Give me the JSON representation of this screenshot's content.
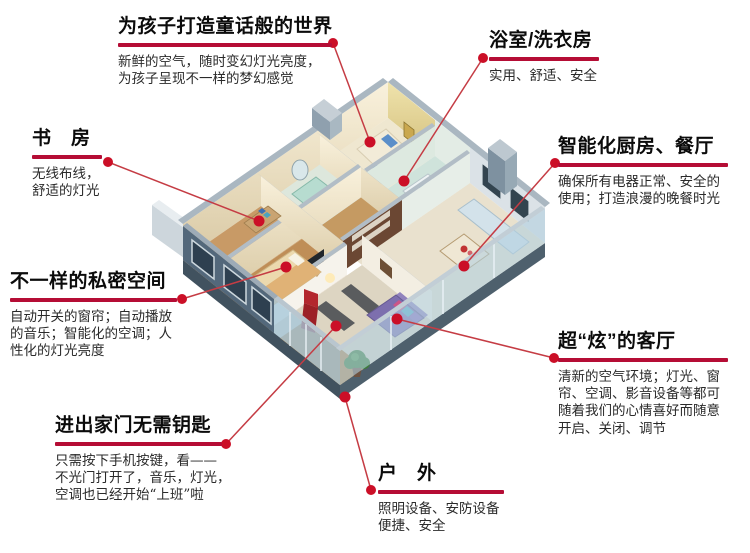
{
  "colors": {
    "accent_red": "#b50d35",
    "connector_red": "#c53c44",
    "dot_red": "#cb0f27",
    "title_text": "#0b0b0b",
    "body_text": "#2a2a2a",
    "background": "#ffffff"
  },
  "illustration": {
    "name": "isometric-smart-home-cutaway-render",
    "marker_count": 8
  },
  "callouts": [
    {
      "id": "children-room",
      "title": "为孩子打造童话般的世界",
      "body": "新鲜的空气，随时变幻灯光亮度，\n为孩子呈现不一样的梦幻感觉"
    },
    {
      "id": "bathroom-laundry",
      "title": "浴室/洗衣房",
      "body": "实用、舒适、安全"
    },
    {
      "id": "study-room",
      "title": "书　房",
      "body": "无线布线，\n舒适的灯光"
    },
    {
      "id": "smart-kitchen-dining",
      "title": "智能化厨房、餐厅",
      "body": "确保所有电器正常、安全的\n使用；打造浪漫的晚餐时光"
    },
    {
      "id": "private-space",
      "title": "不一样的私密空间",
      "body": "自动开关的窗帘；自动播放\n的音乐；智能化的空调；人\n性化的灯光亮度"
    },
    {
      "id": "cool-living-room",
      "title": "超“炫”的客厅",
      "body": "清新的空气环境；灯光、窗\n帘、空调、影音设备等都可\n随着我们的心情喜好而随意\n开启、关闭、调节"
    },
    {
      "id": "keyless-entry",
      "title": "进出家门无需钥匙",
      "body": "只需按下手机按键，看——\n不光门打开了，音乐，灯光，\n空调也已经开始“上班”啦"
    },
    {
      "id": "outdoor",
      "title": "户　外",
      "body": "照明设备、安防设备\n便捷、安全"
    }
  ]
}
